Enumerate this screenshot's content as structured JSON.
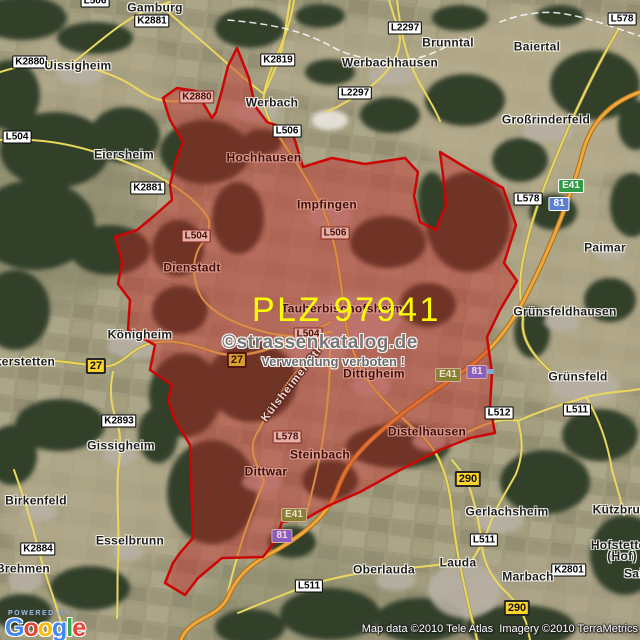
{
  "map": {
    "plz_overlay": "PLZ 97941",
    "watermark_line1": "©strassenkatalog.de",
    "watermark_line2": "Verwendung verboten !",
    "attribution": "Map data ©2010 Tele Atlas  Imagery ©2010 TerraMetrics",
    "logo": {
      "powered_by": "POWERED BY",
      "letters": [
        {
          "ch": "G",
          "color": "#4285F4"
        },
        {
          "ch": "o",
          "color": "#EA4335"
        },
        {
          "ch": "o",
          "color": "#FBBC05"
        },
        {
          "ch": "g",
          "color": "#4285F4"
        },
        {
          "ch": "l",
          "color": "#34A853"
        },
        {
          "ch": "e",
          "color": "#EA4335"
        }
      ]
    },
    "colors": {
      "terrain_tan": "#a09a7d",
      "forest_green": "#33402a",
      "road_yellow": "#ead75e",
      "road_orange": "#f0a73c",
      "overlay_fill": "#c62323",
      "overlay_stroke": "#cc0606",
      "plz_text": "#fdfd00",
      "shield_yellow": "#fdd42a",
      "shield_green": "#2f9b44",
      "shield_blue": "#5c7fd6"
    },
    "labels": [
      {
        "name": "gamburg",
        "text": "Gamburg",
        "x": 155,
        "y": 8,
        "type": "town",
        "tinted": false
      },
      {
        "name": "l506-top",
        "text": "L506",
        "x": 95,
        "y": 1,
        "type": "road",
        "tinted": false
      },
      {
        "name": "k2881-top",
        "text": "K2881",
        "x": 152,
        "y": 21,
        "type": "road",
        "tinted": false
      },
      {
        "name": "k2880-west",
        "text": "K2880",
        "x": 30,
        "y": 62,
        "type": "road",
        "tinted": false
      },
      {
        "name": "uissigheim",
        "text": "Uissigheim",
        "x": 78,
        "y": 66,
        "type": "town",
        "tinted": false
      },
      {
        "name": "k2819",
        "text": "K2819",
        "x": 278,
        "y": 60,
        "type": "road",
        "tinted": false
      },
      {
        "name": "l2297-north",
        "text": "L2297",
        "x": 405,
        "y": 28,
        "type": "road",
        "tinted": false
      },
      {
        "name": "l2297-south",
        "text": "L2297",
        "x": 355,
        "y": 93,
        "type": "road",
        "tinted": false
      },
      {
        "name": "werbachhausen",
        "text": "Werbachhausen",
        "x": 390,
        "y": 63,
        "type": "town",
        "tinted": false
      },
      {
        "name": "brunntal",
        "text": "Brunntal",
        "x": 448,
        "y": 43,
        "type": "town",
        "tinted": false
      },
      {
        "name": "baiertal",
        "text": "Baiertal",
        "x": 537,
        "y": 47,
        "type": "town",
        "tinted": false
      },
      {
        "name": "l578-topright",
        "text": "L578",
        "x": 622,
        "y": 19,
        "type": "road",
        "tinted": false
      },
      {
        "name": "grossrinderfeld",
        "text": "Großrinderfeld",
        "x": 546,
        "y": 120,
        "type": "town",
        "tinted": false
      },
      {
        "name": "werbach",
        "text": "Werbach",
        "x": 272,
        "y": 103,
        "type": "town",
        "tinted": false
      },
      {
        "name": "l506-werbach",
        "text": "L506",
        "x": 287,
        "y": 131,
        "type": "road",
        "tinted": false
      },
      {
        "name": "k2880-border",
        "text": "K2880",
        "x": 197,
        "y": 97,
        "type": "road",
        "tinted": true
      },
      {
        "name": "l504-west",
        "text": "L504",
        "x": 17,
        "y": 137,
        "type": "road",
        "tinted": false
      },
      {
        "name": "eiersheim",
        "text": "Eiersheim",
        "x": 124,
        "y": 155,
        "type": "town",
        "tinted": false
      },
      {
        "name": "hochhausen",
        "text": "Hochhausen",
        "x": 264,
        "y": 158,
        "type": "town",
        "tinted": true
      },
      {
        "name": "k2881-mid",
        "text": "K2881",
        "x": 148,
        "y": 188,
        "type": "road",
        "tinted": false
      },
      {
        "name": "e41-north",
        "text": "E41",
        "x": 571,
        "y": 186,
        "type": "shield-euro",
        "tinted": false
      },
      {
        "name": "l578-right",
        "text": "L578",
        "x": 528,
        "y": 199,
        "type": "road",
        "tinted": false
      },
      {
        "name": "a81-north",
        "text": "81",
        "x": 559,
        "y": 204,
        "type": "shield-autobahn",
        "tinted": false
      },
      {
        "name": "impfingen",
        "text": "Impfingen",
        "x": 327,
        "y": 205,
        "type": "town",
        "tinted": true
      },
      {
        "name": "l506-impfingen",
        "text": "L506",
        "x": 335,
        "y": 233,
        "type": "road",
        "tinted": true
      },
      {
        "name": "l504-region",
        "text": "L504",
        "x": 196,
        "y": 236,
        "type": "road",
        "tinted": true
      },
      {
        "name": "paimar",
        "text": "Paimar",
        "x": 605,
        "y": 248,
        "type": "town",
        "tinted": false
      },
      {
        "name": "dienstadt",
        "text": "Dienstadt",
        "x": 192,
        "y": 268,
        "type": "town",
        "tinted": true
      },
      {
        "name": "tauberbischofsheim",
        "text": "Tauberbischofsheim",
        "x": 342,
        "y": 309,
        "type": "town",
        "tinted": true
      },
      {
        "name": "gruensfeldhausen",
        "text": "Grünsfeldhausen",
        "x": 565,
        "y": 312,
        "type": "town",
        "tinted": false
      },
      {
        "name": "koenigheim",
        "text": "Königheim",
        "x": 140,
        "y": 335,
        "type": "town",
        "tinted": false
      },
      {
        "name": "l504-tbb",
        "text": "L504",
        "x": 308,
        "y": 334,
        "type": "road",
        "tinted": true
      },
      {
        "name": "b27-west",
        "text": "27",
        "x": 96,
        "y": 366,
        "type": "shield-yellow",
        "tinted": false
      },
      {
        "name": "b27-tbb",
        "text": "27",
        "x": 237,
        "y": 360,
        "type": "shield-yellow",
        "tinted": true
      },
      {
        "name": "weikerstetten",
        "text": "Weikerstetten",
        "x": 14,
        "y": 362,
        "type": "town",
        "tinted": false
      },
      {
        "name": "kuelsheimer-strasse",
        "text": "Külsheimer Str",
        "x": 292,
        "y": 384,
        "type": "street",
        "tinted": true,
        "rot": -52
      },
      {
        "name": "dittigheim",
        "text": "Dittigheim",
        "x": 374,
        "y": 374,
        "type": "town",
        "tinted": true
      },
      {
        "name": "e41-mid",
        "text": "E41",
        "x": 448,
        "y": 375,
        "type": "shield-euro",
        "tinted": true
      },
      {
        "name": "a81-mid",
        "text": "81",
        "x": 477,
        "y": 372,
        "type": "shield-autobahn",
        "tinted": true
      },
      {
        "name": "gruensfeld",
        "text": "Grünsfeld",
        "x": 578,
        "y": 377,
        "type": "town",
        "tinted": false
      },
      {
        "name": "l511-gruensfeld",
        "text": "L511",
        "x": 577,
        "y": 410,
        "type": "road",
        "tinted": false
      },
      {
        "name": "l512",
        "text": "L512",
        "x": 499,
        "y": 413,
        "type": "road",
        "tinted": false
      },
      {
        "name": "k2893",
        "text": "K2893",
        "x": 119,
        "y": 421,
        "type": "road",
        "tinted": false
      },
      {
        "name": "distelhausen",
        "text": "Distelhausen",
        "x": 427,
        "y": 432,
        "type": "town",
        "tinted": true
      },
      {
        "name": "l578-steinbach",
        "text": "L578",
        "x": 287,
        "y": 437,
        "type": "road",
        "tinted": true
      },
      {
        "name": "gissigheim",
        "text": "Gissigheim",
        "x": 121,
        "y": 446,
        "type": "town",
        "tinted": false
      },
      {
        "name": "steinbach",
        "text": "Steinbach",
        "x": 320,
        "y": 455,
        "type": "town",
        "tinted": true
      },
      {
        "name": "dittwar",
        "text": "Dittwar",
        "x": 266,
        "y": 472,
        "type": "town",
        "tinted": true
      },
      {
        "name": "b290-north",
        "text": "290",
        "x": 468,
        "y": 479,
        "type": "shield-yellow",
        "tinted": false
      },
      {
        "name": "birkenfeld",
        "text": "Birkenfeld",
        "x": 36,
        "y": 501,
        "type": "town",
        "tinted": false
      },
      {
        "name": "kuetzbrunn",
        "text": "Kützbrunn",
        "x": 624,
        "y": 510,
        "type": "town",
        "tinted": false
      },
      {
        "name": "gerlachsheim",
        "text": "Gerlachsheim",
        "x": 507,
        "y": 512,
        "type": "town",
        "tinted": false
      },
      {
        "name": "e41-south",
        "text": "E41",
        "x": 294,
        "y": 515,
        "type": "shield-euro",
        "tinted": true
      },
      {
        "name": "a81-south",
        "text": "81",
        "x": 282,
        "y": 536,
        "type": "shield-autobahn",
        "tinted": true
      },
      {
        "name": "l511-gerlachsheim",
        "text": "L511",
        "x": 484,
        "y": 540,
        "type": "road",
        "tinted": false
      },
      {
        "name": "esselbrunn",
        "text": "Esselbrunn",
        "x": 130,
        "y": 541,
        "type": "town",
        "tinted": false
      },
      {
        "name": "k2884",
        "text": "K2884",
        "x": 38,
        "y": 549,
        "type": "road",
        "tinted": false
      },
      {
        "name": "hofstetten",
        "text": "Hofstetten\n(Hof)",
        "x": 622,
        "y": 551,
        "type": "town",
        "tinted": false
      },
      {
        "name": "lauda",
        "text": "Lauda",
        "x": 458,
        "y": 563,
        "type": "town",
        "tinted": false
      },
      {
        "name": "brehmen",
        "text": "Brehmen",
        "x": 23,
        "y": 569,
        "type": "town",
        "tinted": false
      },
      {
        "name": "k2801",
        "text": "K2801",
        "x": 569,
        "y": 570,
        "type": "road",
        "tinted": false
      },
      {
        "name": "oberlauda",
        "text": "Oberlauda",
        "x": 384,
        "y": 570,
        "type": "town",
        "tinted": false
      },
      {
        "name": "sailtheim",
        "text": "Sailtheim",
        "x": 652,
        "y": 574,
        "type": "town",
        "tinted": false
      },
      {
        "name": "marbach",
        "text": "Marbach",
        "x": 528,
        "y": 577,
        "type": "town",
        "tinted": false
      },
      {
        "name": "l511-oberlauda",
        "text": "L511",
        "x": 309,
        "y": 586,
        "type": "road",
        "tinted": false
      },
      {
        "name": "b290-south",
        "text": "290",
        "x": 517,
        "y": 608,
        "type": "shield-yellow",
        "tinted": false
      }
    ]
  }
}
